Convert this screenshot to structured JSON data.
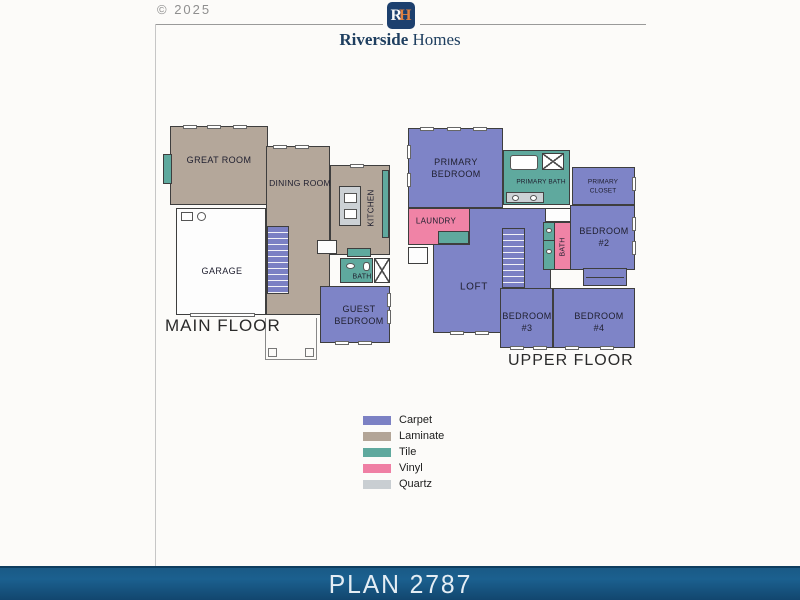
{
  "page": {
    "copyright": "© 2025"
  },
  "header": {
    "logo_letter_r": "R",
    "logo_letter_h": "H",
    "brand_primary": "Riverside",
    "brand_secondary": "Homes"
  },
  "main_floor": {
    "title": "MAIN FLOOR",
    "rooms": {
      "great_room": "GREAT ROOM",
      "dining_room": "DINING ROOM",
      "kitchen": "KITCHEN",
      "garage": "GARAGE",
      "bath": "BATH",
      "guest_bedroom_line1": "GUEST",
      "guest_bedroom_line2": "BEDROOM"
    }
  },
  "upper_floor": {
    "title": "UPPER FLOOR",
    "rooms": {
      "primary_bedroom_line1": "PRIMARY",
      "primary_bedroom_line2": "BEDROOM",
      "primary_bath": "PRIMARY BATH",
      "primary_closet_line1": "PRIMARY",
      "primary_closet_line2": "CLOSET",
      "laundry": "LAUNDRY",
      "loft": "LOFT",
      "bath": "BATH",
      "bedroom_2_line1": "BEDROOM",
      "bedroom_2_line2": "#2",
      "bedroom_3_line1": "BEDROOM",
      "bedroom_3_line2": "#3",
      "bedroom_4_line1": "BEDROOM",
      "bedroom_4_line2": "#4"
    }
  },
  "legend": {
    "items": [
      {
        "label": "Carpet",
        "color": "#7c81c4"
      },
      {
        "label": "Laminate",
        "color": "#b3a597"
      },
      {
        "label": "Tile",
        "color": "#5fa99e"
      },
      {
        "label": "Vinyl",
        "color": "#ef7fa4"
      },
      {
        "label": "Quartz",
        "color": "#c9ced2"
      }
    ]
  },
  "footer": {
    "plan_label": "PLAN 2787"
  },
  "colors": {
    "wall": "#3e3e3e",
    "banner_top": "#1b608f",
    "banner_bottom": "#12466e",
    "logo_navy": "#1d406e",
    "logo_orange": "#e28140",
    "brand_navy": "#1f3f60"
  }
}
